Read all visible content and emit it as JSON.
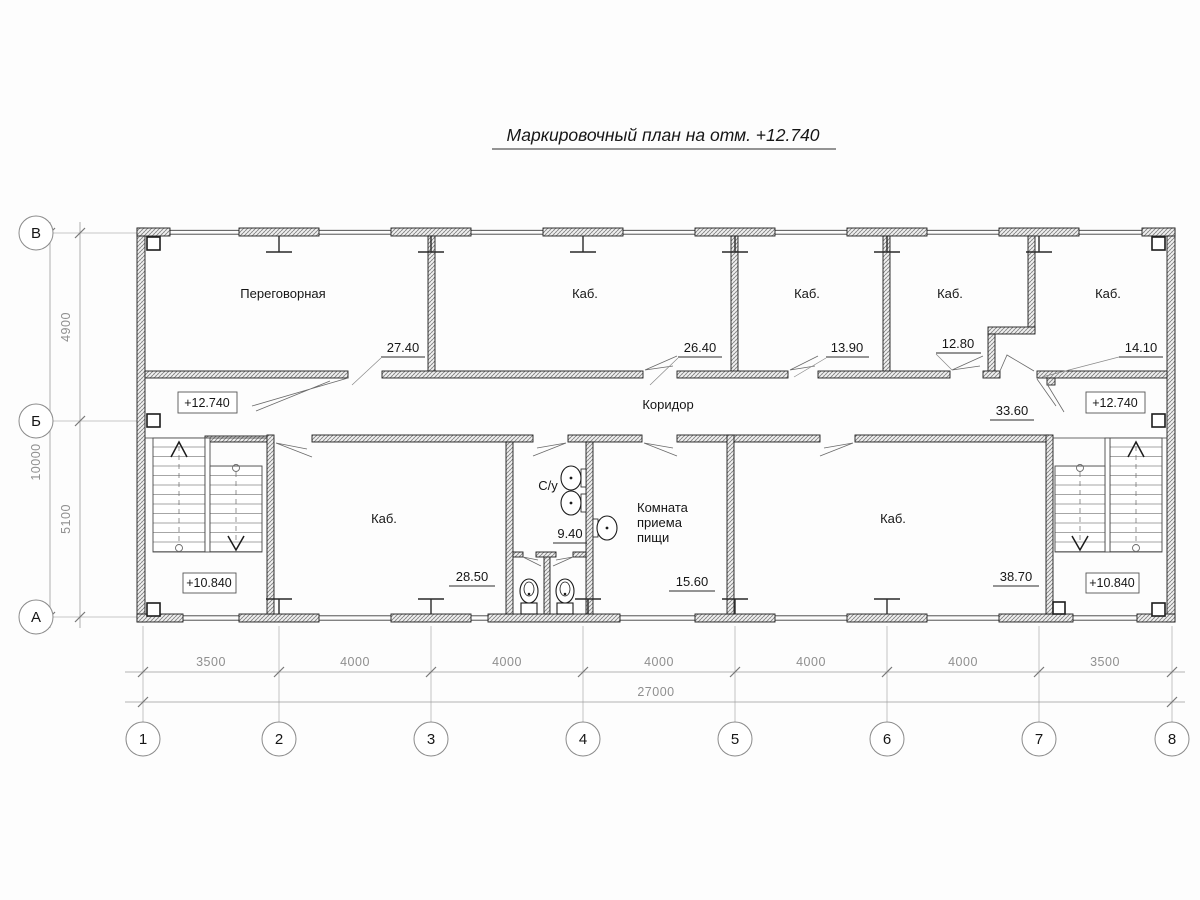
{
  "title": "Маркировочный план на отм. +12.740",
  "axes": {
    "rows": [
      "В",
      "Б",
      "А"
    ],
    "cols": [
      "1",
      "2",
      "3",
      "4",
      "5",
      "6",
      "7",
      "8"
    ]
  },
  "dims": {
    "left_upper": "4900",
    "left_lower": "5100",
    "left_total": "10000",
    "bottom_segments": [
      "3500",
      "4000",
      "4000",
      "4000",
      "4000",
      "4000",
      "3500"
    ],
    "bottom_total": "27000"
  },
  "levels": {
    "upper": "+12.740",
    "lower": "+10.840"
  },
  "rooms": {
    "peregovornaya": {
      "name": "Переговорная",
      "area": "27.40"
    },
    "kab_26": {
      "name": "Каб.",
      "area": "26.40"
    },
    "kab_13": {
      "name": "Каб.",
      "area": "13.90"
    },
    "kab_12": {
      "name": "Каб.",
      "area": "12.80"
    },
    "kab_14": {
      "name": "Каб.",
      "area": "14.10"
    },
    "koridor": {
      "name": "Коридор",
      "area": "33.60"
    },
    "kab_28": {
      "name": "Каб.",
      "area": "28.50"
    },
    "su": {
      "name": "С/у",
      "area": "9.40"
    },
    "komnata": {
      "line1": "Комната",
      "line2": "приема",
      "line3": "пищи",
      "area": "15.60"
    },
    "kab_38": {
      "name": "Каб.",
      "area": "38.70"
    }
  }
}
